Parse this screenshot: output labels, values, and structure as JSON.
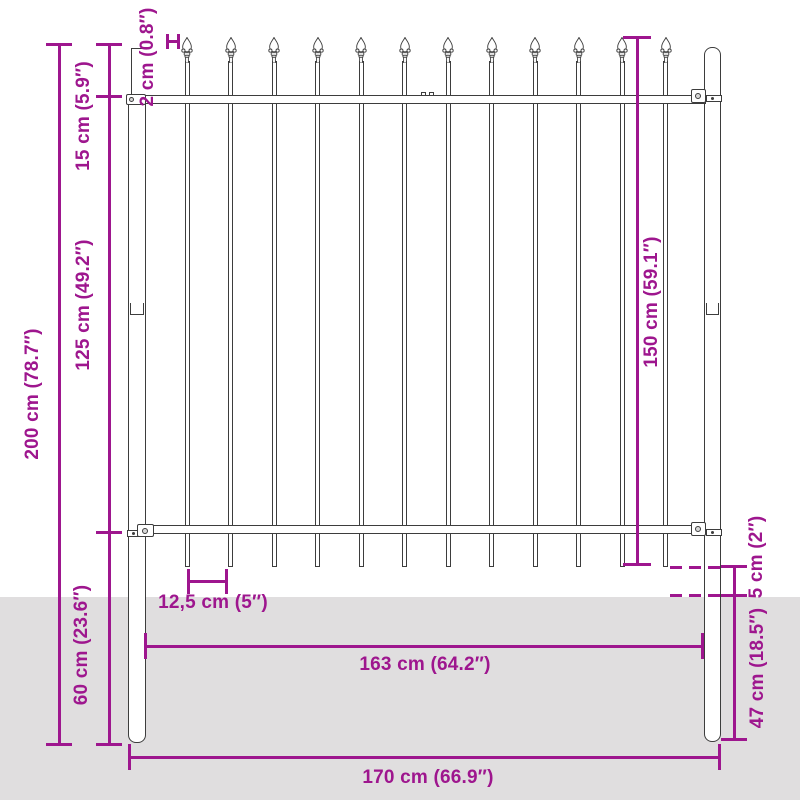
{
  "diagram": {
    "type": "product dimension diagram",
    "subject": "steel fence panel with spear top",
    "colors": {
      "dimension": "#9E168E",
      "outline": "#3d3d3d",
      "ground": "#e0dedf",
      "background": "#ffffff"
    },
    "fence": {
      "bar_count": 12
    },
    "dimensions": {
      "total_height": "200 cm (78.7″)",
      "spear_section_height": "15 cm (5.9″)",
      "mid_section_height": "125 cm (49.2″)",
      "lower_section_height": "60 cm (23.6″)",
      "bar_offset": "2 cm (0.8″)",
      "panel_height": "150 cm (59.1″)",
      "ground_clearance": "5 cm (2″)",
      "post_in_ground_depth": "47 cm (18.5″)",
      "bar_spacing": "12,5 cm (5″)",
      "panel_width": "163 cm (64.2″)",
      "total_width": "170 cm (66.9″)"
    }
  }
}
